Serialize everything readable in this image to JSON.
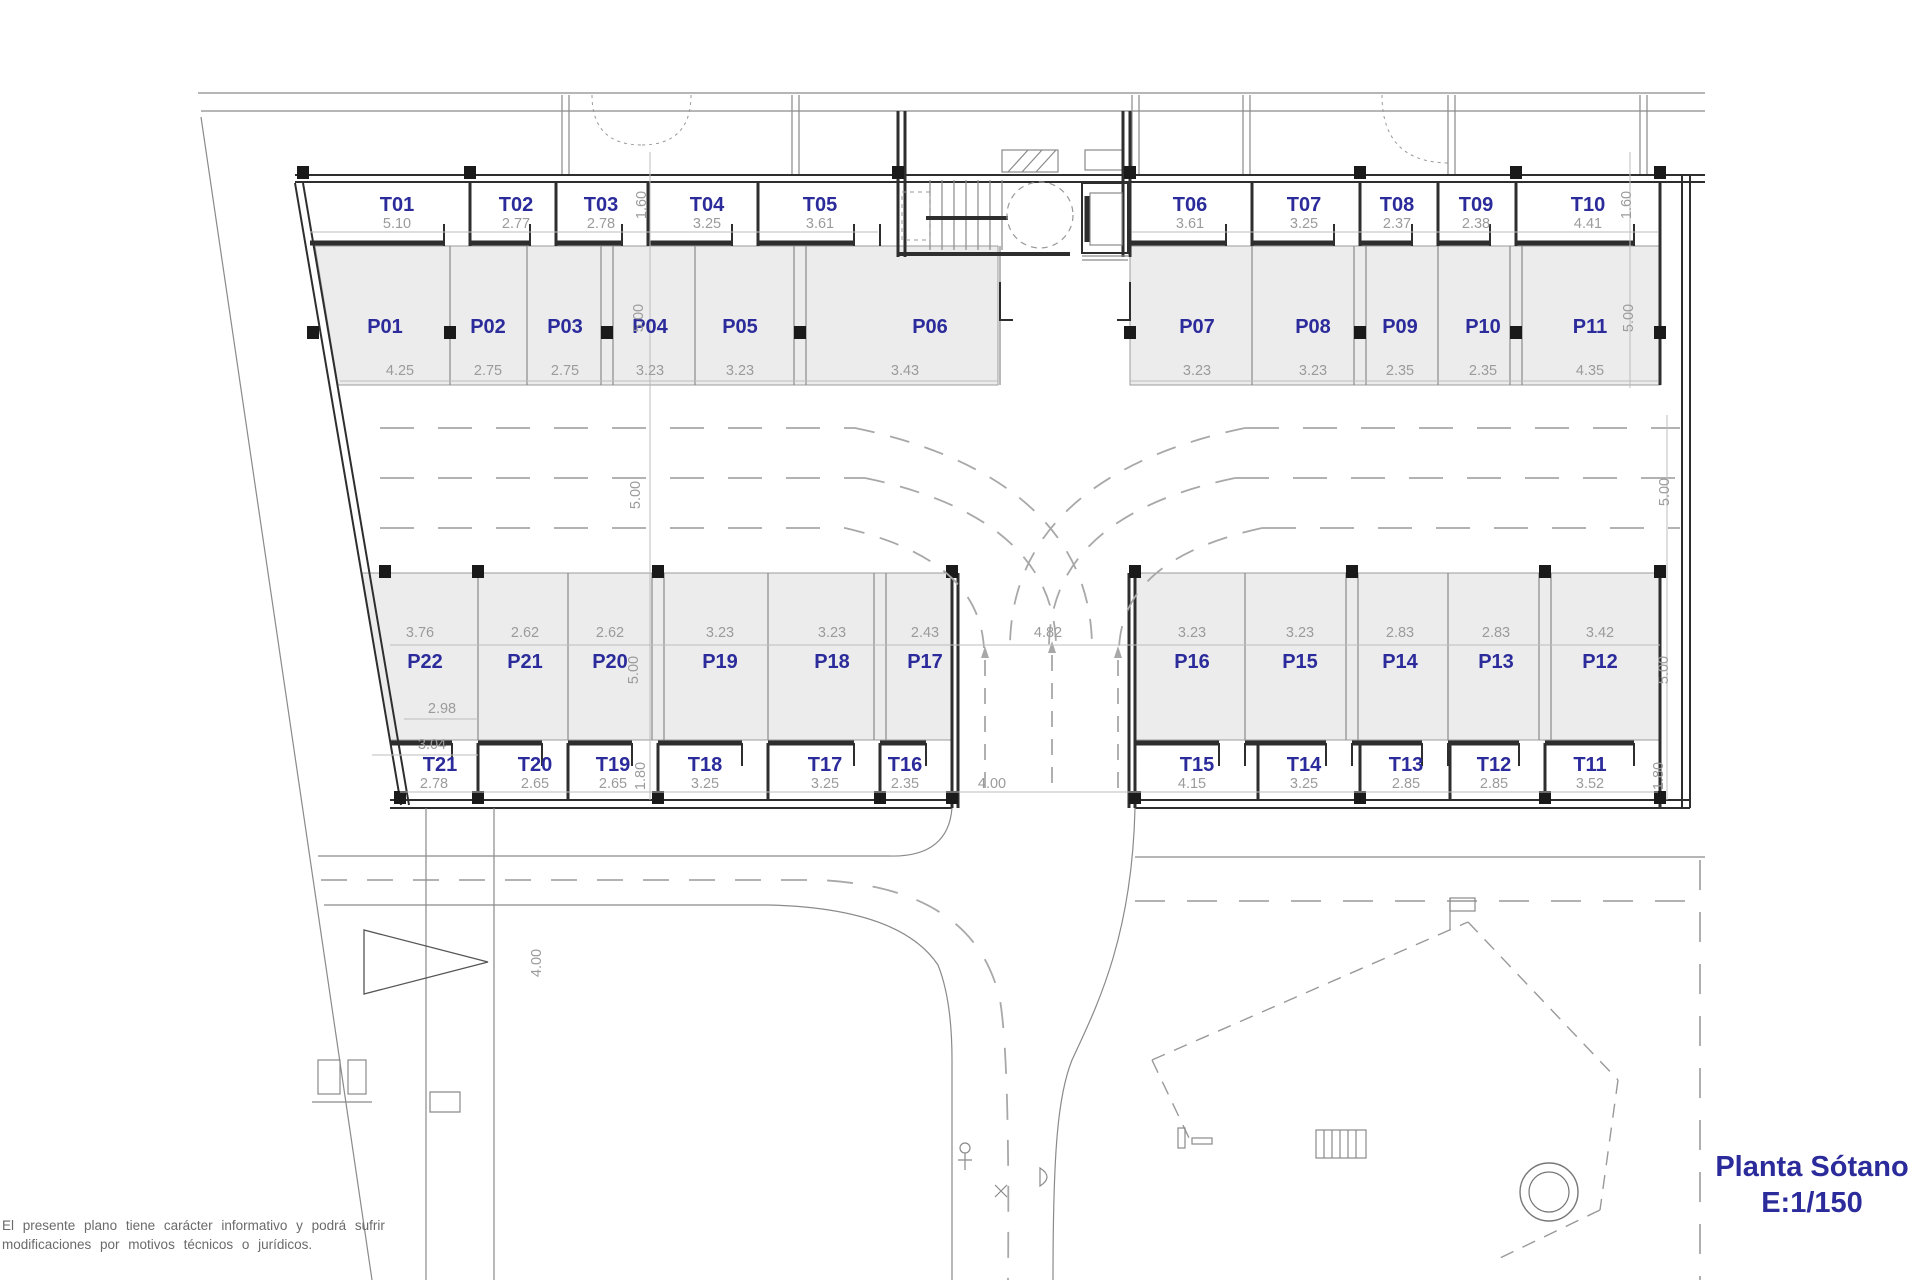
{
  "title": {
    "name": "Planta Sótano",
    "scale": "E:1/150"
  },
  "disclaimer": {
    "line1": "El presente plano tiene carácter informativo y podrá sufrir",
    "line2": "modificaciones por motivos técnicos o jurídicos."
  },
  "colors": {
    "label_blue": "#2b2b9b",
    "dim_gray": "#9b9b9b",
    "wall": "#2e2e2e",
    "stall_fill": "#ececec"
  },
  "top": {
    "storage": [
      {
        "id": "T01",
        "w": "5.10"
      },
      {
        "id": "T02",
        "w": "2.77"
      },
      {
        "id": "T03",
        "w": "2.78"
      },
      {
        "id": "T04",
        "w": "3.25"
      },
      {
        "id": "T05",
        "w": "3.61"
      },
      {
        "id": "T06",
        "w": "3.61"
      },
      {
        "id": "T07",
        "w": "3.25"
      },
      {
        "id": "T08",
        "w": "2.37"
      },
      {
        "id": "T09",
        "w": "2.38"
      },
      {
        "id": "T10",
        "w": "4.41"
      }
    ],
    "parking": [
      {
        "id": "P01",
        "w": "4.25"
      },
      {
        "id": "P02",
        "w": "2.75"
      },
      {
        "id": "P03",
        "w": "2.75"
      },
      {
        "id": "P04",
        "w": "3.23"
      },
      {
        "id": "P05",
        "w": "3.23"
      },
      {
        "id": "P06",
        "w": "3.43"
      },
      {
        "id": "P07",
        "w": "3.23"
      },
      {
        "id": "P08",
        "w": "3.23"
      },
      {
        "id": "P09",
        "w": "2.35"
      },
      {
        "id": "P10",
        "w": "2.35"
      },
      {
        "id": "P11",
        "w": "4.35"
      }
    ]
  },
  "bottom": {
    "parking": [
      {
        "id": "P22",
        "w": "3.76"
      },
      {
        "id": "P21",
        "w": "2.62"
      },
      {
        "id": "P20",
        "w": "2.62"
      },
      {
        "id": "P19",
        "w": "3.23"
      },
      {
        "id": "P18",
        "w": "3.23"
      },
      {
        "id": "P17",
        "w": "2.43"
      },
      {
        "id": "P16",
        "w": "3.23"
      },
      {
        "id": "P15",
        "w": "3.23"
      },
      {
        "id": "P14",
        "w": "2.83"
      },
      {
        "id": "P13",
        "w": "2.83"
      },
      {
        "id": "P12",
        "w": "3.42"
      }
    ],
    "storage": [
      {
        "id": "T21",
        "w": "2.78"
      },
      {
        "id": "T20",
        "w": "2.65"
      },
      {
        "id": "T19",
        "w": "2.65"
      },
      {
        "id": "T18",
        "w": "3.25"
      },
      {
        "id": "T17",
        "w": "3.25"
      },
      {
        "id": "T16",
        "w": "2.35"
      },
      {
        "id": "T15",
        "w": "4.15"
      },
      {
        "id": "T14",
        "w": "3.25"
      },
      {
        "id": "T13",
        "w": "2.85"
      },
      {
        "id": "T12",
        "w": "2.85"
      },
      {
        "id": "T11",
        "w": "3.52"
      }
    ]
  },
  "dims": {
    "ramp_opening": "4.82",
    "ramp_width": "4.00",
    "access_width": "4.00",
    "t_depth_top": "1.60",
    "t_depth_bottom": "1.80",
    "p_depth": "5.00",
    "aisle": "5.00",
    "p22_front": "2.98",
    "p22_back": "3.04"
  }
}
